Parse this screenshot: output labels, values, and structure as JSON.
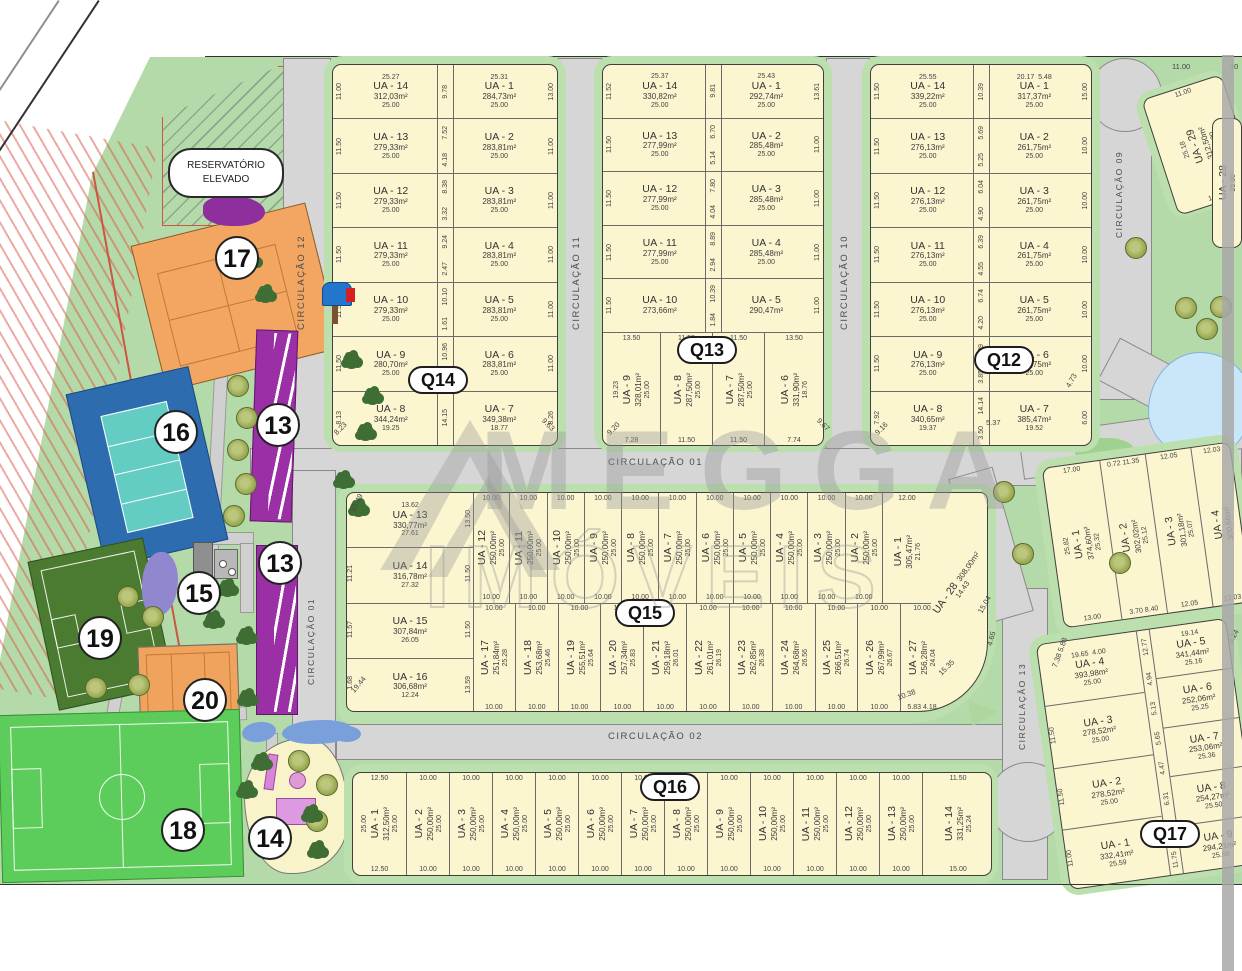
{
  "watermark": {
    "brand": "MEGGA",
    "sub": "IMÓVEIS"
  },
  "reservoir": {
    "line1": "RESERVATÓRIO",
    "line2": "ELEVADO"
  },
  "markers": {
    "m17": "17",
    "m16": "16",
    "m15": "15",
    "m13a": "13",
    "m13b": "13",
    "m19": "19",
    "m20": "20",
    "m18": "18",
    "m14": "14"
  },
  "labels": {
    "q14": "Q14",
    "q13": "Q13",
    "q12": "Q12",
    "q15": "Q15",
    "q16": "Q16",
    "q17": "Q17"
  },
  "roads": {
    "c12": "CIRCULAÇÃO 12",
    "c11": "CIRCULAÇÃO 11",
    "c10": "CIRCULAÇÃO 10",
    "c09": "CIRCULAÇÃO 09",
    "c01": "CIRCULAÇÃO 01",
    "c01w": "CIRCULAÇÃO 01",
    "c02": "CIRCULAÇÃO 02",
    "c13": "CIRCULAÇÃO 13"
  },
  "q14": {
    "rows": [
      {
        "ld": "11.00",
        "md": "9.78",
        "rd": "13.00",
        "l": {
          "t": "25.27",
          "n": "UA - 14",
          "a": "312,03m²",
          "d": "25.00"
        },
        "r": {
          "t": "25.31",
          "n": "UA - 1",
          "a": "284,73m²",
          "d": "25.00"
        }
      },
      {
        "ld": "11.50",
        "md": "7.52",
        "md2": "4.18",
        "rd": "11.00",
        "l": {
          "n": "UA - 13",
          "a": "279,33m²",
          "d": "25.00"
        },
        "r": {
          "n": "UA - 2",
          "a": "283,81m²",
          "d": "25.00"
        }
      },
      {
        "ld": "11.50",
        "md": "8.38",
        "md2": "3.32",
        "rd": "11.00",
        "l": {
          "n": "UA - 12",
          "a": "279,33m²",
          "d": "25.00"
        },
        "r": {
          "n": "UA - 3",
          "a": "283,81m²",
          "d": "25.00"
        }
      },
      {
        "ld": "11.50",
        "md": "9.24",
        "md2": "2.47",
        "rd": "11.00",
        "l": {
          "n": "UA - 11",
          "a": "279,33m²",
          "d": "25.00"
        },
        "r": {
          "n": "UA - 4",
          "a": "283,81m²",
          "d": "25.00"
        }
      },
      {
        "ld": "11.50",
        "md": "10.10",
        "md2": "1.61",
        "rd": "11.00",
        "l": {
          "n": "UA - 10",
          "a": "279,33m²",
          "d": "25.00"
        },
        "r": {
          "n": "UA - 5",
          "a": "283,81m²",
          "d": "25.00"
        }
      },
      {
        "ld": "11.50",
        "md": "10.96",
        "md2": "0.75",
        "rd": "11.00",
        "l": {
          "n": "UA - 9",
          "a": "280,70m²",
          "d": "25.00"
        },
        "r": {
          "n": "UA - 6",
          "a": "283,81m²",
          "d": "25.00"
        }
      },
      {
        "ld": "8.13",
        "md": "14.15",
        "rd": "8.26",
        "l": {
          "n": "UA - 8",
          "a": "344,24m²",
          "b": "19.25"
        },
        "r": {
          "n": "UA - 7",
          "a": "349,38m²",
          "b": "18.77"
        }
      }
    ]
  },
  "q13": {
    "rows": [
      {
        "ld": "11.52",
        "md": "9.81",
        "rd": "13.61",
        "l": {
          "t": "25.37",
          "n": "UA - 14",
          "a": "330,82m²",
          "d": "25.00"
        },
        "r": {
          "t": "25.43",
          "n": "UA - 1",
          "a": "292,74m²",
          "d": "25.00"
        }
      },
      {
        "ld": "11.50",
        "md": "6.70",
        "md2": "5.14",
        "rd": "11.00",
        "l": {
          "n": "UA - 13",
          "a": "277,99m²",
          "d": "25.00"
        },
        "r": {
          "n": "UA -  2",
          "a": "285,48m²",
          "d": "25.00"
        }
      },
      {
        "ld": "11.50",
        "md": "7.80",
        "md2": "4.04",
        "rd": "11.00",
        "l": {
          "n": "UA - 12",
          "a": "277,99m²",
          "d": "25.00"
        },
        "r": {
          "n": "UA - 3",
          "a": "285,48m²",
          "d": "25.00"
        }
      },
      {
        "ld": "11.50",
        "md": "8.89",
        "md2": "2.94",
        "rd": "11.00",
        "l": {
          "n": "UA - 11",
          "a": "277,99m²",
          "d": "25.00"
        },
        "r": {
          "n": "UA - 4",
          "a": "285,48m²",
          "d": "25.00"
        }
      },
      {
        "ld": "11.50",
        "md": "10.39",
        "md2": "1.84",
        "rd": "11.00",
        "l": {
          "n": "UA - 10",
          "a": "273,66m²"
        },
        "r": {
          "n": "UA - 5",
          "a": "290,47m²"
        }
      }
    ],
    "bottom": [
      {
        "t": "13.50",
        "n": "UA - 9",
        "a": "328,01m²",
        "l": "19.23",
        "d": "25.00",
        "b": "7.28"
      },
      {
        "t": "11.50",
        "n": "UA - 8",
        "a": "287,50m²",
        "d": "25.00",
        "b": "11.50"
      },
      {
        "t": "11.50",
        "n": "UA - 7",
        "a": "287,50m²",
        "d": "25.00",
        "b": "11.50"
      },
      {
        "t": "13.50",
        "n": "UA - 6",
        "a": "331,90m²",
        "d": "18.76",
        "b": "7.74"
      }
    ]
  },
  "q12": {
    "rows": [
      {
        "ld": "11.50",
        "md": "10.39",
        "rd": "15.00",
        "l": {
          "t": "25.55",
          "n": "UA - 14",
          "a": "339,22m²",
          "d": "25.00"
        },
        "r": {
          "t": "20.17",
          "t2": "5.48",
          "n": "UA - 1",
          "a": "317,37m²",
          "d": "25.00"
        }
      },
      {
        "ld": "11.50",
        "md": "5.69",
        "md2": "5.25",
        "rd": "10.00",
        "l": {
          "n": "UA - 13",
          "a": "276,13m²",
          "d": "25.00"
        },
        "r": {
          "n": "UA - 2",
          "a": "261,75m²",
          "d": "25.00"
        }
      },
      {
        "ld": "11.50",
        "md": "6.04",
        "md2": "4.90",
        "rd": "10.00",
        "l": {
          "n": "UA - 12",
          "a": "276,13m²",
          "d": "25.00"
        },
        "r": {
          "n": "UA - 3",
          "a": "261,75m²",
          "d": "25.00"
        }
      },
      {
        "ld": "11.50",
        "md": "6.39",
        "md2": "4.55",
        "rd": "10.00",
        "l": {
          "n": "UA - 11",
          "a": "276,13m²",
          "d": "25.00"
        },
        "r": {
          "n": "UA - 4",
          "a": "261,75m²",
          "d": "25.00"
        }
      },
      {
        "ld": "11.50",
        "md": "6.74",
        "md2": "4.20",
        "rd": "10.00",
        "l": {
          "n": "UA - 10",
          "a": "276,13m²",
          "d": "25.00"
        },
        "r": {
          "n": "UA - 5",
          "a": "261,75m²",
          "d": "25.00"
        }
      },
      {
        "ld": "11.50",
        "md": "7.09",
        "md2": "3.85",
        "rd": "10.00",
        "l": {
          "n": "UA - 9",
          "a": "276,13m²",
          "d": "25.00"
        },
        "r": {
          "n": "UA - 6",
          "a": "261,75m²",
          "d": "25.00"
        }
      },
      {
        "ld": "7.92",
        "md": "14.14",
        "md2": "3.50",
        "rd": "6.00",
        "l": {
          "n": "UA - 8",
          "a": "340,65m²",
          "b": "19.37"
        },
        "r": {
          "n": "UA - 7",
          "a": "385,47m²",
          "b": "19.52"
        }
      }
    ]
  },
  "q15": {
    "west": [
      {
        "t": "13.62",
        "n": "UA - 13",
        "a": "330,77m²",
        "d": "27.61",
        "r": "13.50"
      },
      {
        "n": "UA - 14",
        "a": "316,78m²",
        "d": "27.32",
        "l": "11.21",
        "r": "11.50"
      },
      {
        "n": "UA - 15",
        "a": "307,84m²",
        "d": "26.05",
        "l": "11.57",
        "r": "11.50"
      },
      {
        "n": "UA - 16",
        "a": "306,68m²",
        "d": "12.24",
        "l": "1.68",
        "r": "13.59"
      }
    ],
    "top": [
      {
        "t": "10.00",
        "n": "UA - 12",
        "a": "250,00m²",
        "d": "25.00",
        "b": "10.00"
      },
      {
        "t": "10.00",
        "n": "UA - 11",
        "a": "250,00m²",
        "d": "25.00",
        "b": "10.00"
      },
      {
        "t": "10.00",
        "n": "UA - 10",
        "a": "250,00m²",
        "d": "25.00",
        "b": "10.00"
      },
      {
        "t": "10.00",
        "n": "UA - 9",
        "a": "250,00m²",
        "d": "25.00",
        "b": "10.00"
      },
      {
        "t": "10.00",
        "n": "UA - 8",
        "a": "250,00m²",
        "d": "25.00",
        "b": "10.00"
      },
      {
        "t": "10.00",
        "n": "UA - 7",
        "a": "250,00m²",
        "d": "25.00",
        "b": "10.00"
      },
      {
        "t": "10.00",
        "n": "UA - 6",
        "a": "250,00m²",
        "d": "25.00",
        "b": "10.00"
      },
      {
        "t": "10.00",
        "n": "UA - 5",
        "a": "250,00m²",
        "d": "25.00",
        "b": "10.00"
      },
      {
        "t": "10.00",
        "n": "UA - 4",
        "a": "250,00m²",
        "d": "25.00",
        "b": "10.00"
      },
      {
        "t": "10.00",
        "n": "UA - 3",
        "a": "250,00m²",
        "d": "25.00",
        "b": "10.00"
      },
      {
        "t": "10.00",
        "n": "UA - 2",
        "a": "250,00m²",
        "d": "25.00",
        "b": "10.00"
      },
      {
        "t": "12.00",
        "n": "UA - 1",
        "a": "305,47m²",
        "d": "21.76"
      }
    ],
    "bottom": [
      {
        "t": "10.00",
        "n": "UA - 17",
        "a": "251,84m²",
        "d": "25.28",
        "b": "10.00"
      },
      {
        "t": "10.00",
        "n": "UA - 18",
        "a": "253,68m²",
        "d": "25.46",
        "b": "10.00"
      },
      {
        "t": "10.00",
        "n": "UA - 19",
        "a": "255,51m²",
        "d": "25.64",
        "b": "10.00"
      },
      {
        "t": "10.00",
        "n": "UA - 20",
        "a": "257,34m²",
        "d": "25.83",
        "b": "10.00"
      },
      {
        "t": "10.00",
        "n": "UA - 21",
        "a": "259,18m²",
        "d": "26.01",
        "b": "10.00"
      },
      {
        "t": "10.00",
        "n": "UA - 22",
        "a": "261,01m²",
        "d": "26.19",
        "b": "10.00"
      },
      {
        "t": "10.00",
        "n": "UA - 23",
        "a": "262,85m²",
        "d": "26.38",
        "b": "10.00"
      },
      {
        "t": "10.00",
        "n": "UA - 24",
        "a": "264,68m²",
        "d": "26.56",
        "b": "10.00"
      },
      {
        "t": "10.00",
        "n": "UA - 25",
        "a": "266,51m²",
        "d": "26.74",
        "b": "10.00"
      },
      {
        "t": "10.00",
        "n": "UA - 26",
        "a": "267,99m²",
        "d": "26.67",
        "b": "10.00"
      },
      {
        "t": "10.00",
        "n": "UA - 27",
        "a": "256,28m²",
        "d": "24.04",
        "b": "5.83 4.18"
      }
    ],
    "ua28": {
      "n": "UA - 28",
      "a": "308,00m²"
    }
  },
  "q16": {
    "lots": [
      {
        "t": "12.50",
        "l": "25.00",
        "n": "UA - 1",
        "a": "312,50m²",
        "d": "25.00",
        "b": "12.50"
      },
      {
        "t": "10.00",
        "n": "UA - 2",
        "a": "250,00m²",
        "d": "25.00",
        "b": "10.00"
      },
      {
        "t": "10.00",
        "n": "UA - 3",
        "a": "250,00m²",
        "d": "25.00",
        "b": "10.00"
      },
      {
        "t": "10.00",
        "n": "UA - 4",
        "a": "250,00m²",
        "d": "25.00",
        "b": "10.00"
      },
      {
        "t": "10.00",
        "n": "UA - 5",
        "a": "250,00m²",
        "d": "25.00",
        "b": "10.00"
      },
      {
        "t": "10.00",
        "n": "UA - 6",
        "a": "250,00m²",
        "d": "25.00",
        "b": "10.00"
      },
      {
        "t": "10.00",
        "n": "UA - 7",
        "a": "250,00m²",
        "d": "25.00",
        "b": "10.00"
      },
      {
        "t": "10.00",
        "n": "UA - 8",
        "a": "250,00m²",
        "d": "25.00",
        "b": "10.00"
      },
      {
        "t": "10.00",
        "n": "UA - 9",
        "a": "250,00m²",
        "d": "25.00",
        "b": "10.00"
      },
      {
        "t": "10.00",
        "n": "UA - 10",
        "a": "250,00m²",
        "d": "25.00",
        "b": "10.00"
      },
      {
        "t": "10.00",
        "n": "UA - 11",
        "a": "250,00m²",
        "d": "25.00",
        "b": "10.00"
      },
      {
        "t": "10.00",
        "n": "UA - 12",
        "a": "250,00m²",
        "d": "25.00",
        "b": "10.00"
      },
      {
        "t": "10.00",
        "n": "UA - 13",
        "a": "250,00m²",
        "d": "25.00",
        "b": "10.00"
      },
      {
        "t": "11.50",
        "n": "UA - 14",
        "a": "331,25m²",
        "d": "25.24",
        "b": "15.00"
      }
    ]
  },
  "right_block": {
    "lots": [
      {
        "t": "17.00",
        "l": "25.82",
        "n": "UA - 1",
        "a": "374,60m²",
        "d": "25.32",
        "b": "13.00"
      },
      {
        "t": "0.72 11.35",
        "n": "UA - 2",
        "a": "302,02m²",
        "d": "25.12",
        "b": "3.70 8.40"
      },
      {
        "t": "12.05",
        "n": "UA - 3",
        "a": "301,18m²",
        "d": "25.07",
        "b": "12.05"
      },
      {
        "t": "12.03",
        "n": "UA - 4",
        "a": "300,66m²",
        "b": "12.03"
      }
    ]
  },
  "q17": {
    "left": [
      {
        "t": "19.65",
        "t2": "4.00",
        "n": "UA - 4",
        "a": "393,98m²",
        "d": "25.00"
      },
      {
        "l": "11.50",
        "n": "UA - 3",
        "a": "278,52m²",
        "d": "25.00"
      },
      {
        "l": "11.50",
        "n": "UA - 2",
        "a": "278,52m²",
        "d": "25.00"
      },
      {
        "l": "11.00",
        "n": "UA - 1",
        "a": "332,41m²",
        "d": "25.59"
      }
    ],
    "right": [
      {
        "t": "19.14",
        "n": "UA - 5",
        "a": "341,44m²",
        "d": "25.16"
      },
      {
        "n": "UA - 6",
        "a": "252,06m²",
        "d": "25.25"
      },
      {
        "n": "UA - 7",
        "a": "253,06m²",
        "d": "25.36"
      },
      {
        "n": "UA - 8",
        "a": "254,27m²",
        "d": "25.50"
      },
      {
        "n": "UA - 9",
        "a": "294,21m²",
        "d": "25.68"
      }
    ],
    "mid": [
      "12.77",
      "4.94",
      "5.13",
      "5.65",
      "4.47",
      "6.31",
      "3.85",
      "11.75"
    ]
  },
  "ua29": {
    "t": "11.00",
    "l": "25.18",
    "n": "UA - 29",
    "a": "312,50m²",
    "d": "25.00",
    "b": "14.00"
  },
  "ua28_top": {
    "n": "UA - 28",
    "d": "25.00"
  },
  "annotations": [
    {
      "t": "8.23",
      "x": 333,
      "y": 424,
      "r": -45
    },
    {
      "t": "9.63",
      "x": 541,
      "y": 420,
      "r": 45
    },
    {
      "t": "9.20",
      "x": 606,
      "y": 424,
      "r": -45
    },
    {
      "t": "9.67",
      "x": 816,
      "y": 420,
      "r": 45
    },
    {
      "t": "9.16",
      "x": 874,
      "y": 424,
      "r": -45
    },
    {
      "t": "5.37",
      "x": 986,
      "y": 418,
      "r": 0
    },
    {
      "t": "4.73",
      "x": 1064,
      "y": 376,
      "r": -60
    },
    {
      "t": "21.49",
      "x": 347,
      "y": 498,
      "r": -62
    },
    {
      "t": "19.44",
      "x": 349,
      "y": 680,
      "r": -50
    },
    {
      "t": "14.43",
      "x": 953,
      "y": 585,
      "r": -55
    },
    {
      "t": "15.04",
      "x": 975,
      "y": 600,
      "r": -60
    },
    {
      "t": "15.35",
      "x": 937,
      "y": 663,
      "r": -45
    },
    {
      "t": "10.38",
      "x": 897,
      "y": 690,
      "r": -20
    },
    {
      "t": "4.65",
      "x": 984,
      "y": 634,
      "r": -75
    },
    {
      "t": "7.38 5.88",
      "x": 1044,
      "y": 648,
      "r": -70
    },
    {
      "t": "9.24",
      "x": 1226,
      "y": 632,
      "r": -60
    },
    {
      "t": "11.00",
      "x": 1172,
      "y": 62,
      "r": 0
    },
    {
      "t": "10",
      "x": 1230,
      "y": 62,
      "r": 0
    }
  ]
}
